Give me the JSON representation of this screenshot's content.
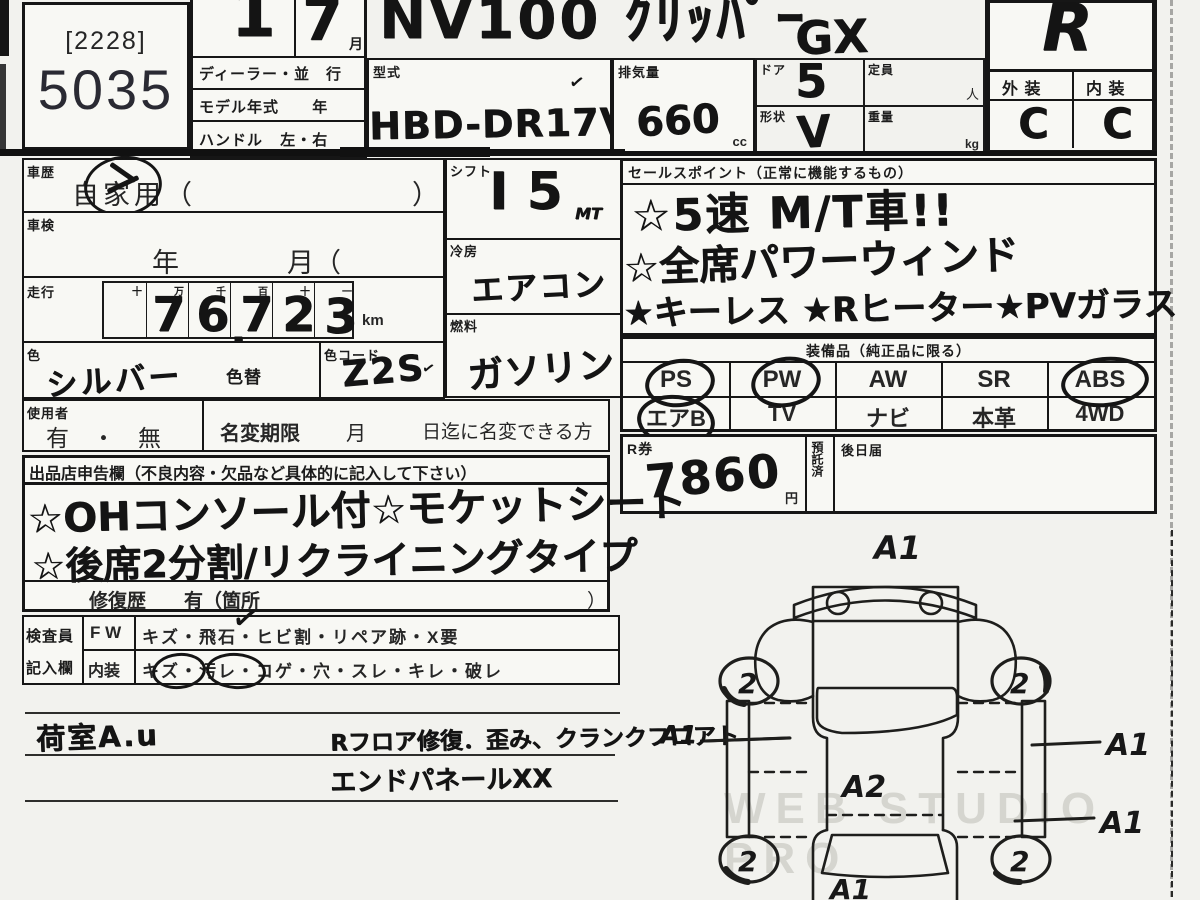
{
  "lot": {
    "bracket": "[2228]",
    "number": "5035"
  },
  "header": {
    "count": "1",
    "month": "7",
    "month_unit": "月",
    "row1": "ディーラー・並　行",
    "row2_label": "モデル年式",
    "row2_unit": "年",
    "row3_label": "ハンドル",
    "row3_value": "左・右",
    "car_name": "NV100 ｸﾘｯﾊﾟｰ",
    "car_grade": "GX",
    "model_label": "型式",
    "model_code": "HBD-DR17V",
    "model_tick": "✓",
    "disp_label": "排気量",
    "disp": "660",
    "disp_unit": "cc",
    "door_label": "ドア",
    "door": "5",
    "capacity_label": "定員",
    "capacity_unit": "人",
    "shape_label": "形状",
    "shape": "V",
    "weight_label": "重量",
    "weight_unit": "kg"
  },
  "grade": {
    "overall": "R",
    "ext_label": "外 装",
    "int_label": "内 装",
    "ext": "C",
    "int": "C"
  },
  "history": {
    "label": "車歴",
    "value": "自家用（",
    "close": "）"
  },
  "shaken": {
    "label": "車検",
    "value": "年　　　　月（　　　日）"
  },
  "mileage": {
    "label": "走行",
    "headers": [
      "十",
      "万",
      "千",
      "百",
      "十",
      "一"
    ],
    "digits": [
      "7",
      "6",
      "7",
      "2",
      "3"
    ],
    "comma": ",",
    "unit": "km"
  },
  "color": {
    "label": "色",
    "value": "シルバー",
    "change": "色替",
    "code_label": "色コード",
    "code": "Z2S",
    "tick": "✓"
  },
  "shift": {
    "label": "シフト",
    "value": "I 5",
    "suffix": "MT"
  },
  "cool": {
    "label": "冷房",
    "value": "エアコン"
  },
  "fuel": {
    "label": "燃料",
    "value": "ガソリン"
  },
  "sales": {
    "label": "セールスポイント（正常に機能するもの）",
    "line1": "☆5速 M/T車!!",
    "line2": "☆全席パワーウィンド",
    "line3": "★キーレス ★Rヒーター★PVガラス"
  },
  "equipment": {
    "label": "装備品（純正品に限る）",
    "row1": [
      "PS",
      "PW",
      "AW",
      "SR",
      "ABS"
    ],
    "row2": [
      "エアB",
      "TV",
      "ナビ",
      "本革",
      "4WD"
    ],
    "circled": [
      "PS",
      "PW",
      "ABS",
      "エアB"
    ]
  },
  "rticket": {
    "label": "R券",
    "value": "7860",
    "unit": "円",
    "deposit": "預託済",
    "later": "後日届"
  },
  "user": {
    "label": "使用者",
    "value": "有　・　無",
    "rename_label": "名変期限",
    "rename_month": "月",
    "rename_note": "日迄に名変できる方"
  },
  "seller": {
    "label": "出品店申告欄（不良内容・欠品など具体的に記入して下さい）",
    "line1": "☆OHコンソール付☆モケットシート",
    "line2": "☆後席2分割/リクライニングタイプ",
    "repair": "修復歴　　有（箇所",
    "repair_close": "）"
  },
  "inspector": {
    "label_top": "検査員",
    "label_bottom": "記入欄",
    "head1": "F W",
    "items1": "キズ・飛石・ヒビ割・リペア跡・X要",
    "head2": "内装",
    "items2": "キズ・汚レ・コゲ・穴・スレ・キレ・破レ",
    "check": "✓"
  },
  "notes": {
    "left": "荷室A.u",
    "right1": "Rフロア修復．歪み、クランクフロアト",
    "pointer_label": "A1",
    "right2": "エンドパネールXX"
  },
  "diagram": {
    "front": "A1",
    "center": "A2",
    "rear": "A1",
    "right1": "A1",
    "right2": "A1",
    "wheel_fl": "2",
    "wheel_fr": "2",
    "wheel_rl": "2",
    "wheel_rr": "2"
  },
  "watermark": "WEB STUDIO PRO"
}
